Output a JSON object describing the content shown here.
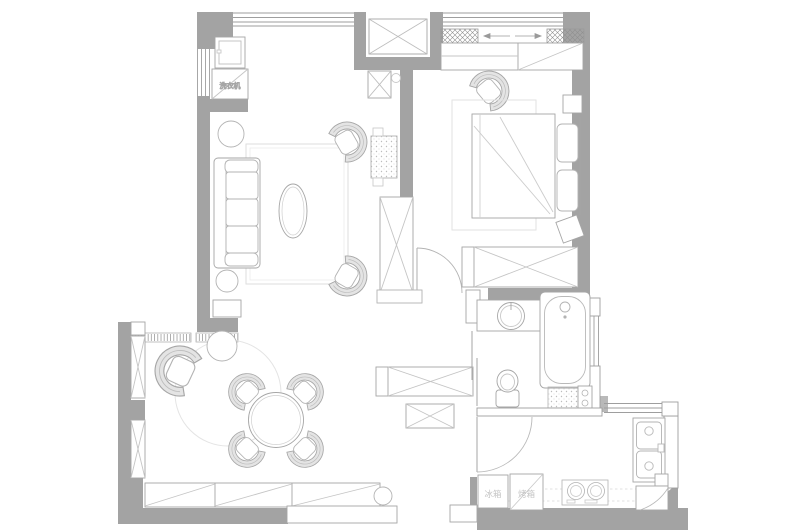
{
  "labels": {
    "fridge": "冰箱",
    "oven": "烤箱",
    "washer": "洗衣机"
  },
  "colors": {
    "wall": "#a3a3a3",
    "wall_light": "#b9b9b9",
    "outline": "#a6a6a6",
    "light": "#c9c9c9",
    "faint": "#e2e2e2",
    "label": "#c3c3c3",
    "label_faint": "#cfcfcf",
    "chair_fill": "#e4e4e4",
    "background": "#ffffff"
  }
}
